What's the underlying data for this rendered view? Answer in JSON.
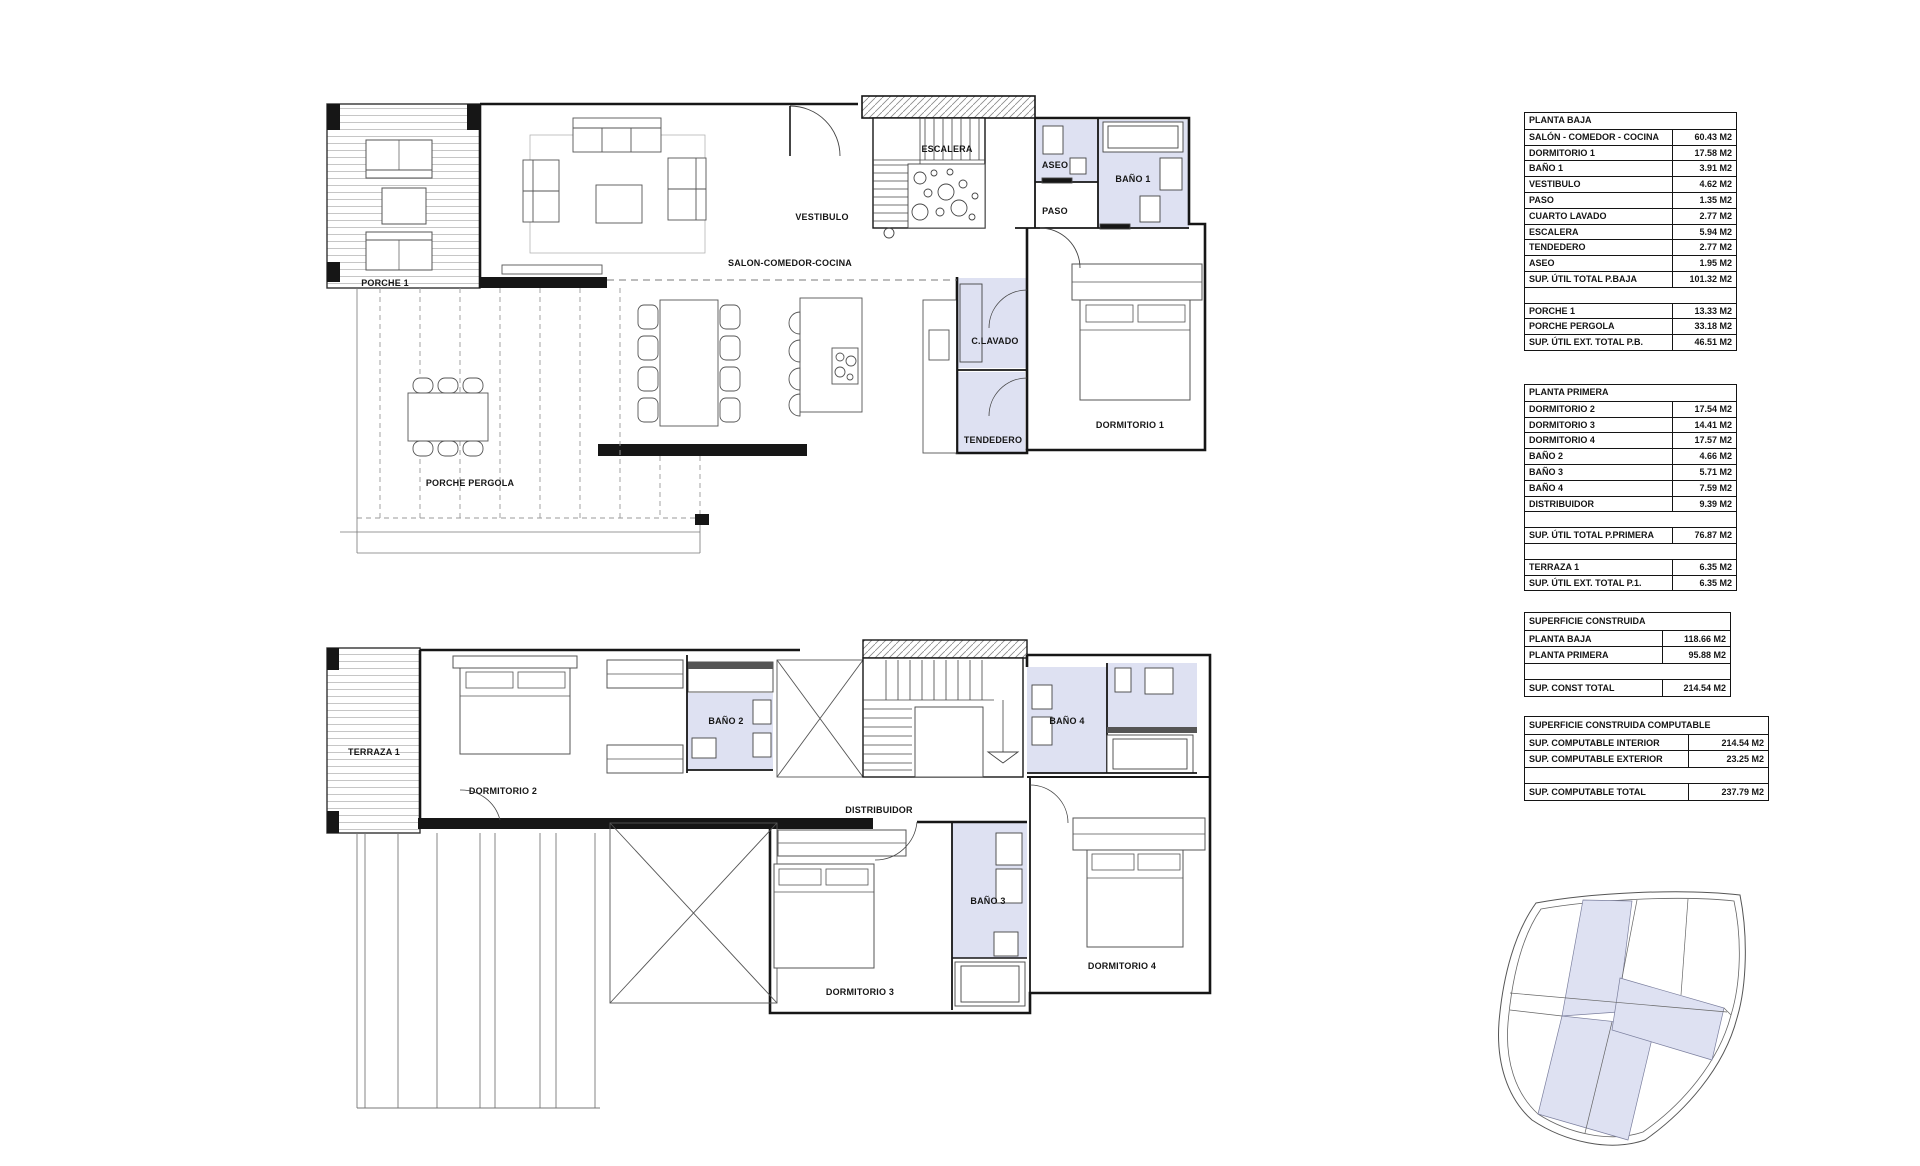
{
  "colors": {
    "wet_room_fill": "#dee1f2",
    "wall_line": "#161616",
    "hatch_line": "#c6c6c6",
    "site_parcel_shade": "#dee1f2"
  },
  "tables": [
    {
      "title": "PLANTA BAJA",
      "rows": [
        {
          "label": "SALÓN - COMEDOR - COCINA",
          "value": "60.43 M2"
        },
        {
          "label": "DORMITORIO 1",
          "value": "17.58 M2"
        },
        {
          "label": "BAÑO 1",
          "value": "3.91 M2"
        },
        {
          "label": "VESTIBULO",
          "value": "4.62 M2"
        },
        {
          "label": "PASO",
          "value": "1.35 M2"
        },
        {
          "label": "CUARTO LAVADO",
          "value": "2.77 M2"
        },
        {
          "label": "ESCALERA",
          "value": "5.94 M2"
        },
        {
          "label": "TENDEDERO",
          "value": "2.77 M2"
        },
        {
          "label": "ASEO",
          "value": "1.95 M2"
        },
        {
          "label": "SUP. ÚTIL TOTAL P.BAJA",
          "value": "101.32 M2",
          "total": true
        },
        {
          "label": "",
          "value": ""
        },
        {
          "label": "PORCHE 1",
          "value": "13.33 M2"
        },
        {
          "label": "PORCHE PERGOLA",
          "value": "33.18 M2"
        },
        {
          "label": "SUP. ÚTIL  EXT. TOTAL P.B.",
          "value": "46.51 M2",
          "total": true
        }
      ]
    },
    {
      "title": "PLANTA PRIMERA",
      "rows": [
        {
          "label": "DORMITORIO 2",
          "value": "17.54 M2"
        },
        {
          "label": "DORMITORIO 3",
          "value": "14.41 M2"
        },
        {
          "label": "DORMITORIO 4",
          "value": "17.57 M2"
        },
        {
          "label": "BAÑO 2",
          "value": "4.66 M2"
        },
        {
          "label": "BAÑO 3",
          "value": "5.71 M2"
        },
        {
          "label": "BAÑO 4",
          "value": "7.59 M2"
        },
        {
          "label": "DISTRIBUIDOR",
          "value": "9.39 M2"
        },
        {
          "label": "",
          "value": ""
        },
        {
          "label": "SUP. ÚTIL TOTAL P.PRIMERA",
          "value": "76.87 M2",
          "total": true
        },
        {
          "label": "",
          "value": ""
        },
        {
          "label": "TERRAZA 1",
          "value": "6.35 M2"
        },
        {
          "label": "SUP. ÚTIL  EXT. TOTAL P.1.",
          "value": "6.35 M2",
          "total": true
        }
      ]
    },
    {
      "title": "SUPERFICIE CONSTRUIDA",
      "rows": [
        {
          "label": "PLANTA BAJA",
          "value": "118.66 M2"
        },
        {
          "label": "PLANTA PRIMERA",
          "value": "95.88 M2"
        },
        {
          "label": "",
          "value": ""
        },
        {
          "label": "SUP. CONST TOTAL",
          "value": "214.54 M2",
          "total": true
        }
      ]
    },
    {
      "title": "SUPERFICIE CONSTRUIDA COMPUTABLE",
      "rows": [
        {
          "label": "SUP. COMPUTABLE INTERIOR",
          "value": "214.54 M2"
        },
        {
          "label": "SUP. COMPUTABLE EXTERIOR",
          "value": "23.25 M2"
        },
        {
          "label": "",
          "value": ""
        },
        {
          "label": "SUP. COMPUTABLE TOTAL",
          "value": "237.79 M2",
          "total": true
        }
      ]
    }
  ],
  "plans": {
    "planta_baja": {
      "rooms": {
        "porche_1": "PORCHE 1",
        "salon": "SALON-COMEDOR-COCINA",
        "vestibulo": "VESTIBULO",
        "escalera": "ESCALERA",
        "aseo": "ASEO",
        "bano_1": "BAÑO 1",
        "paso": "PASO",
        "c_lavado": "C.LAVADO",
        "tendedero": "TENDEDERO",
        "dormitorio_1": "DORMITORIO 1",
        "porche_pergola": "PORCHE PERGOLA"
      }
    },
    "planta_primera": {
      "rooms": {
        "terraza_1": "TERRAZA 1",
        "dormitorio_2": "DORMITORIO 2",
        "bano_2": "BAÑO 2",
        "distribuidor": "DISTRIBUIDOR",
        "bano_4": "BAÑO 4",
        "bano_3": "BAÑO 3",
        "dormitorio_3": "DORMITORIO 3",
        "dormitorio_4": "DORMITORIO 4"
      }
    }
  }
}
